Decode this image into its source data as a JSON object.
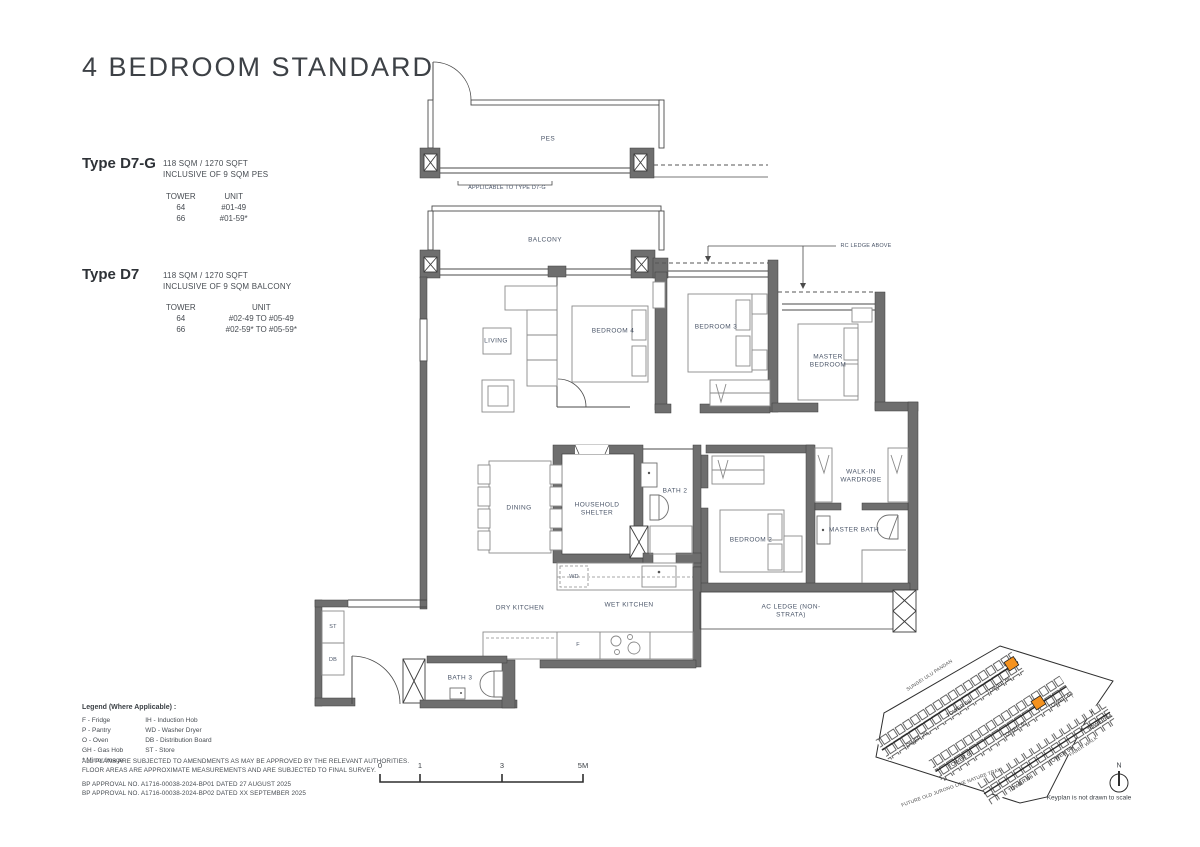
{
  "page": {
    "title": "4 BEDROOM STANDARD"
  },
  "types": [
    {
      "name": "Type D7-G",
      "area": "118 SQM / 1270 SQFT",
      "inclusive": "INCLUSIVE OF 9 SQM PES",
      "tower_header": "TOWER",
      "unit_header": "UNIT",
      "rows": [
        {
          "tower": "64",
          "unit": "#01-49"
        },
        {
          "tower": "66",
          "unit": "#01-59*"
        }
      ]
    },
    {
      "name": "Type D7",
      "area": "118 SQM / 1270 SQFT",
      "inclusive": "INCLUSIVE OF 9 SQM BALCONY",
      "tower_header": "TOWER",
      "unit_header": "UNIT",
      "rows": [
        {
          "tower": "64",
          "unit": "#02-49 TO #05-49"
        },
        {
          "tower": "66",
          "unit": "#02-59* TO #05-59*"
        }
      ]
    }
  ],
  "plan": {
    "labels": {
      "pes": "PES",
      "applicable": "APPLICABLE TO TYPE D7-G",
      "balcony": "BALCONY",
      "living": "LIVING",
      "bedroom4": "BEDROOM 4",
      "bedroom3": "BEDROOM 3",
      "master_bedroom": "MASTER BEDROOM",
      "rc_ledge": "RC LEDGE ABOVE",
      "dining": "DINING",
      "household_shelter": "HOUSEHOLD SHELTER",
      "bath2": "BATH 2",
      "walk_in_wardrobe": "WALK-IN WARDROBE",
      "bedroom2": "BEDROOM 2",
      "master_bath": "MASTER BATH",
      "wd": "WD",
      "dry_kitchen": "DRY KITCHEN",
      "wet_kitchen": "WET KITCHEN",
      "ac_ledge": "AC LEDGE (NON-STRATA)",
      "st": "ST",
      "db": "DB",
      "bath3": "BATH 3",
      "f": "F"
    }
  },
  "legend": {
    "title": "Legend (Where Applicable) :",
    "col1": [
      "F - Fridge",
      "P - Pantry",
      "O - Oven",
      "GH - Gas Hob",
      "* Mirror Image"
    ],
    "col2": [
      "IH - Induction Hob",
      "WD - Washer Dryer",
      "DB - Distribution Board",
      "ST - Store"
    ]
  },
  "notes": [
    "ALL PLANS ARE SUBJECTED TO AMENDMENTS AS MAY BE APPROVED BY THE RELEVANT AUTHORITIES.",
    "FLOOR AREAS ARE APPROXIMATE MEASUREMENTS AND ARE SUBJECTED TO FINAL SURVEY."
  ],
  "approvals": [
    "BP APPROVAL NO. A1716-00038-2024-BP01  DATED 27 AUGUST 2025",
    "BP APPROVAL NO. A1716-00038-2024-BP02  DATED XX SEPTEMBER 2025"
  ],
  "scalebar": {
    "t0": "0",
    "t1": "1",
    "t2": "3",
    "t3": "5M"
  },
  "keyplan": {
    "towers": [
      "TOWER 70",
      "TOWER 68",
      "TOWER 66",
      "TOWER 60",
      "TOWER 62",
      "TOWER 64",
      "TOWER 58",
      "TOWER 56",
      "TOWER 54"
    ],
    "roads": [
      "SUNGEI ULU PANDAN",
      "FUTURE OLD JURONG LINE NATURE TRAIL",
      "FABER WALK"
    ],
    "note": "Keyplan is not drawn to scale",
    "north_label": "N",
    "highlight_color": "#F5921E"
  }
}
